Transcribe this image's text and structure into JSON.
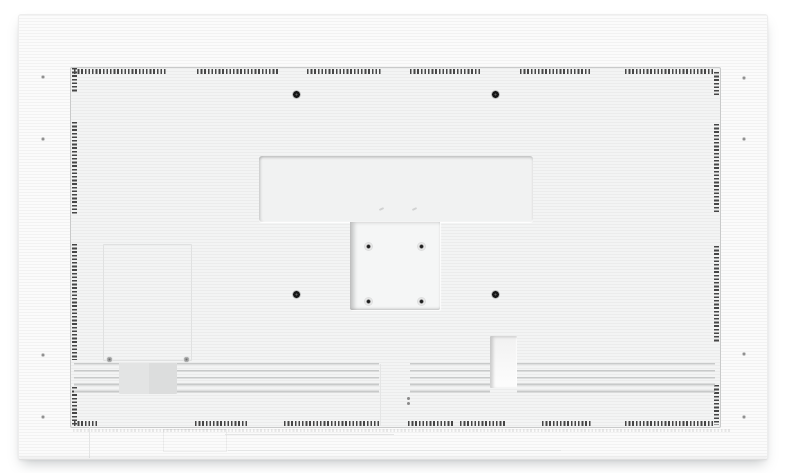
{
  "scene": {
    "type": "product-photograph",
    "subject": "Rear view of a white wall-mountable flat panel display",
    "orientation": "landscape",
    "background_color": "#ffffff"
  },
  "device": {
    "body_color": "#fbfbfb",
    "back_cover_color": "#f3f4f4",
    "outline_color": "#c9caca",
    "texture": "fine horizontal ribbing"
  },
  "features": {
    "perforated_vent_border": {
      "sides": [
        "top",
        "right",
        "bottom",
        "left"
      ],
      "dash_color": "#464646"
    },
    "wall_mount_holes": {
      "count": 4,
      "color": "#151515"
    },
    "vesa_plate": {
      "screw_holes": 4
    },
    "frame_screw_holes": {
      "count": 8
    },
    "service_panel": {
      "screws": 2
    },
    "bottom_vent_slats": {
      "rows": 5,
      "line_color": "#c8caca"
    },
    "label_sticker": {
      "color": "#dcdddd"
    },
    "cable_recess": {
      "present": true
    },
    "alignment_dots": {
      "count": 2
    }
  }
}
